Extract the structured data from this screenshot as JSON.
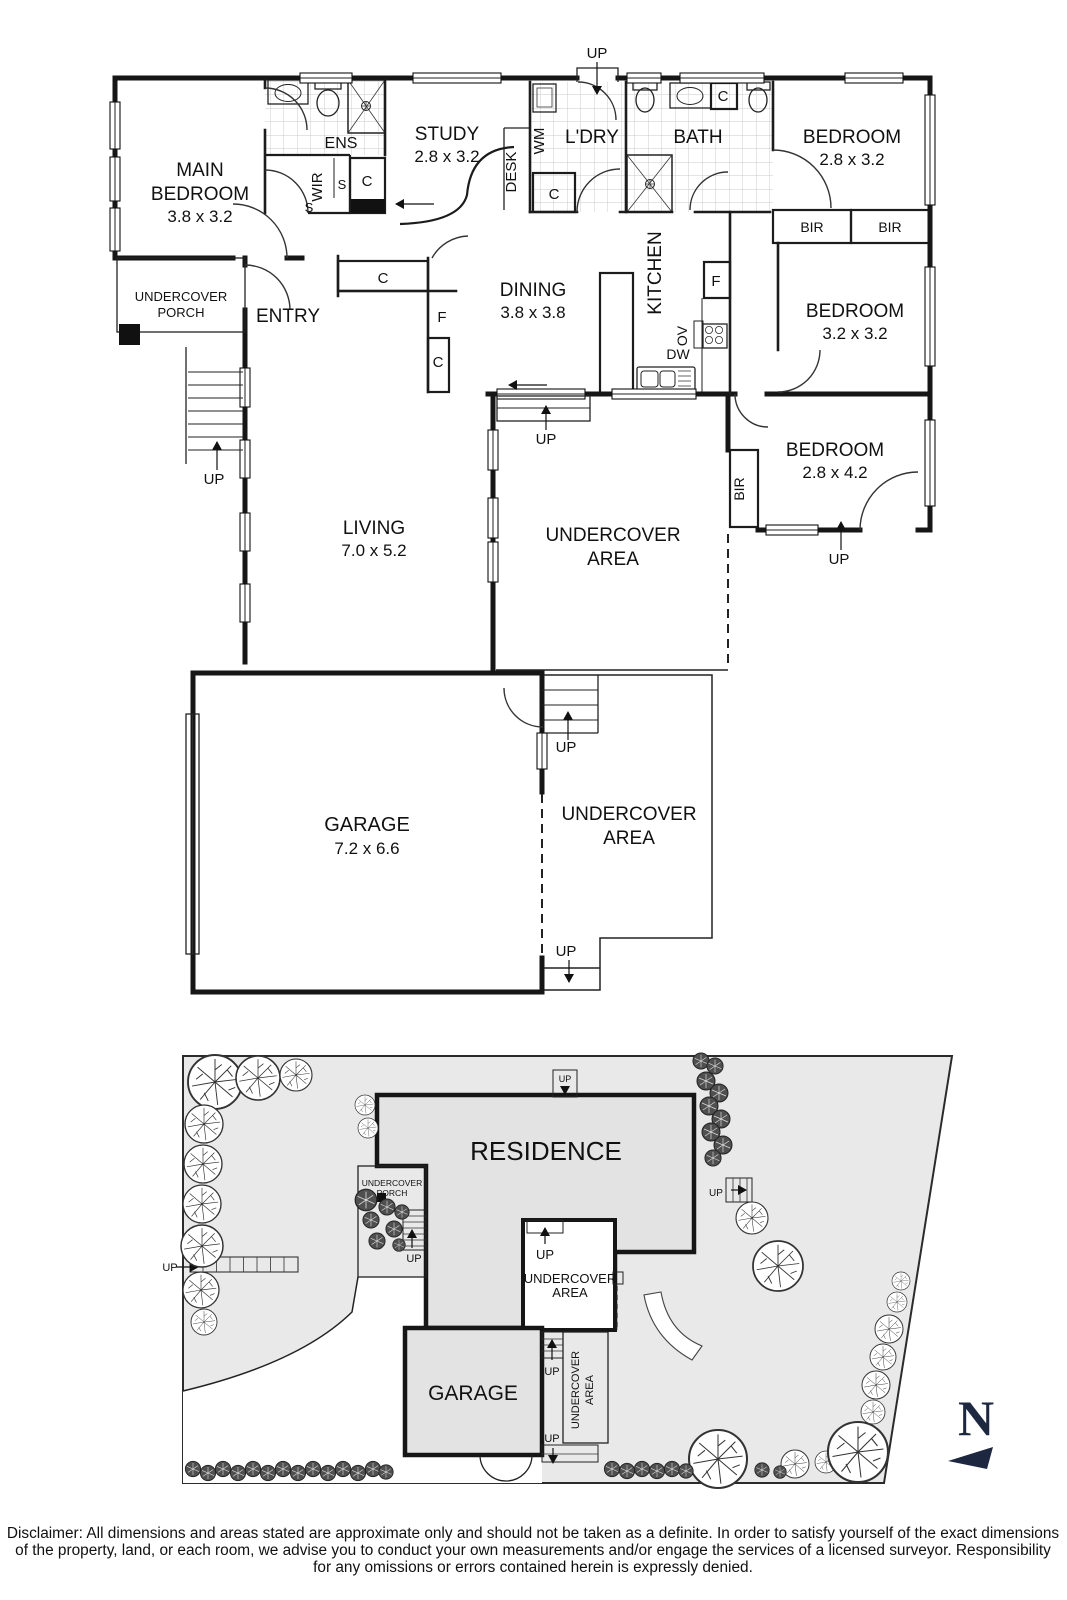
{
  "strings": {
    "up": "UP",
    "c": "C",
    "f": "F",
    "s": "S",
    "ov": "OV",
    "dw": "DW",
    "wm": "WM",
    "bir": "BIR",
    "ens": "ENS",
    "wir": "WIR",
    "desk": "DESK",
    "ldry": "L'DRY",
    "bath": "BATH",
    "kitchen": "KITCHEN",
    "entry": "ENTRY",
    "undercover": "UNDERCOVER",
    "area": "AREA",
    "porch": "PORCH",
    "main": "MAIN",
    "bedroom": "BEDROOM",
    "study": "STUDY",
    "dining": "DINING",
    "living": "LIVING",
    "garage": "GARAGE",
    "residence": "RESIDENCE",
    "compass_n": "N",
    "dims_main_bedroom": "3.8 x 3.2",
    "dims_study": "2.8 x 3.2",
    "dims_bedroom1": "2.8 x 3.2",
    "dims_bedroom2": "3.2 x 3.2",
    "dims_bedroom3": "2.8 x 4.2",
    "dims_dining": "3.8 x 3.8",
    "dims_living": "7.0 x 5.2",
    "dims_garage": "7.2 x 6.6"
  },
  "disclaimer": {
    "line1": "Disclaimer: All dimensions and areas stated are approximate only and should not be taken as a definite. In order to satisfy yourself of the exact dimensions",
    "line2": "of the property, land, or each room, we advise you to conduct your own measurements and/or engage the services of a licensed surveyor. Responsibility",
    "line3": "for any omissions or errors contained herein is expressly denied."
  },
  "colors": {
    "wall": "#161616",
    "site_lawn": "#e9e9e9",
    "building_fill": "#e3e3e3",
    "compass_navy": "#1e2740",
    "tile_line": "#c9c9c9"
  }
}
